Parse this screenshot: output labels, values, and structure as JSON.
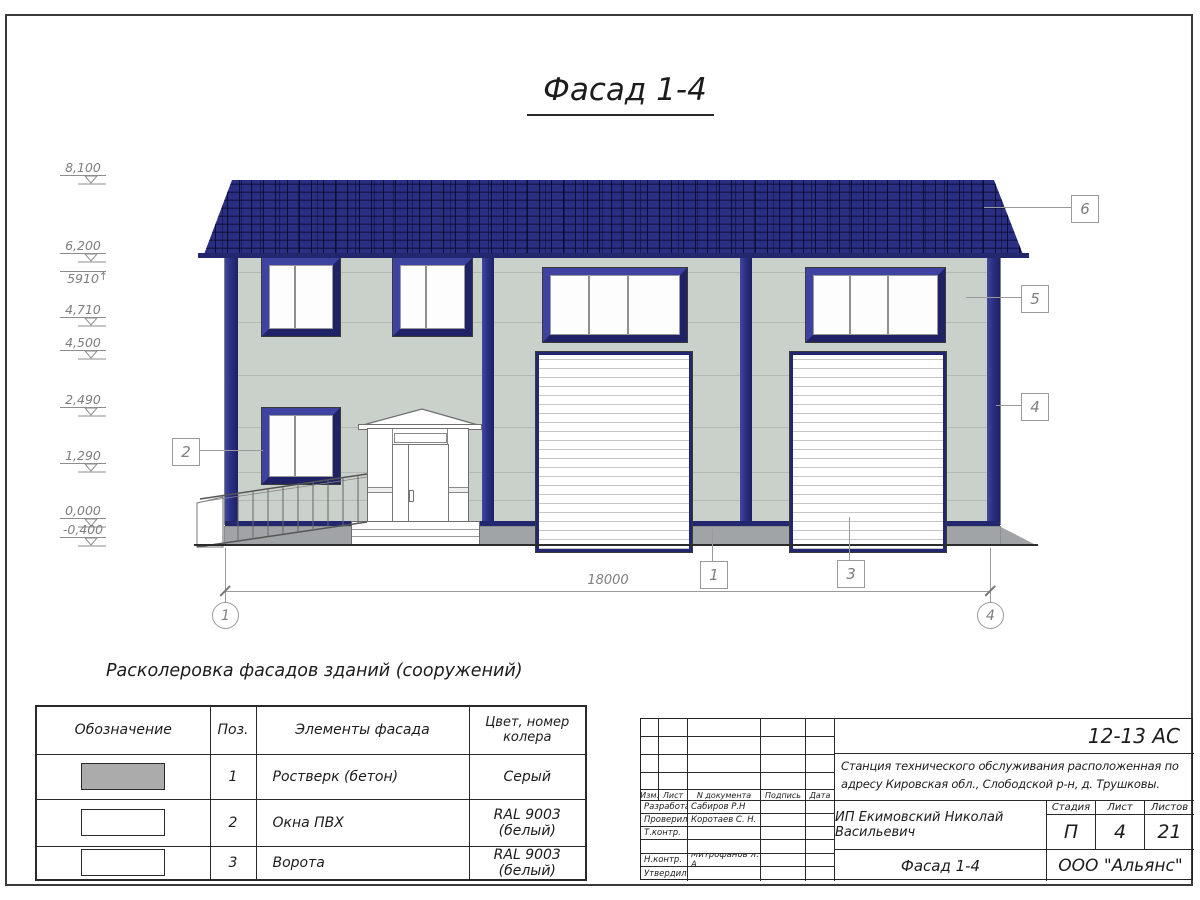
{
  "drawing": {
    "title": "Фасад 1-4",
    "dimension_total": "18000",
    "axis_left": "1",
    "axis_right": "4"
  },
  "elevations": [
    {
      "value": "8,100"
    },
    {
      "value": "6,200"
    },
    {
      "value": "5910",
      "arrow": "↑"
    },
    {
      "value": "4,710"
    },
    {
      "value": "4,500"
    },
    {
      "value": "2,490"
    },
    {
      "value": "1,290"
    },
    {
      "value": "0,000"
    },
    {
      "value": "-0,400"
    }
  ],
  "callouts": {
    "c1": "1",
    "c2": "2",
    "c3": "3",
    "c4": "4",
    "c5": "5",
    "c6": "6"
  },
  "color_table": {
    "title": "Расколеровка фасадов зданий (сооружений)",
    "headers": {
      "designation": "Обозначение",
      "pos": "Поз.",
      "element": "Элементы фасада",
      "color": "Цвет, номер колера"
    },
    "rows": [
      {
        "pos": "1",
        "element": "Ростверк (бетон)",
        "color": "Серый"
      },
      {
        "pos": "2",
        "element": "Окна ПВХ",
        "color": "RAL 9003 (белый)"
      },
      {
        "pos": "3",
        "element": "Ворота",
        "color": "RAL 9003 (белый)"
      }
    ],
    "swatch_colors": {
      "row1": "#ababab",
      "row2": "#ffffff",
      "row3": "#ffffff"
    }
  },
  "title_block": {
    "doc_code": "12-13 АС",
    "description": "Станция технического обслуживания расположенная по адресу Кировская обл., Слободской р-н, д. Трушковы.",
    "client": "ИП Екимовский Николай Васильевич",
    "sheet_title": "Фасад 1-4",
    "company": "ООО \"Альянс\"",
    "cols": {
      "izm": "Изм.",
      "list": "Лист",
      "ndoc": "N документа",
      "podpis": "Подпись",
      "data": "Дата"
    },
    "stage": {
      "label": "Стадия",
      "value": "П"
    },
    "sheet": {
      "label": "Лист",
      "value": "4"
    },
    "sheets": {
      "label": "Листов",
      "value": "21"
    },
    "rows": [
      {
        "role": "Разработал",
        "name": "Сабиров Р.Н"
      },
      {
        "role": "Проверил",
        "name": "Коротаев С. Н."
      },
      {
        "role": "Т.контр.",
        "name": ""
      },
      {
        "role": "",
        "name": ""
      },
      {
        "role": "Н.контр.",
        "name": "Митрофанов Я. А."
      },
      {
        "role": "Утвердил",
        "name": ""
      }
    ]
  },
  "colors": {
    "roof_navy": "#2b2f84",
    "trim_navy": "#23276e",
    "wall_sage": "#cad0ca",
    "plinth_gray": "#a0a4a6",
    "annotation_gray": "#7e7e7e"
  }
}
